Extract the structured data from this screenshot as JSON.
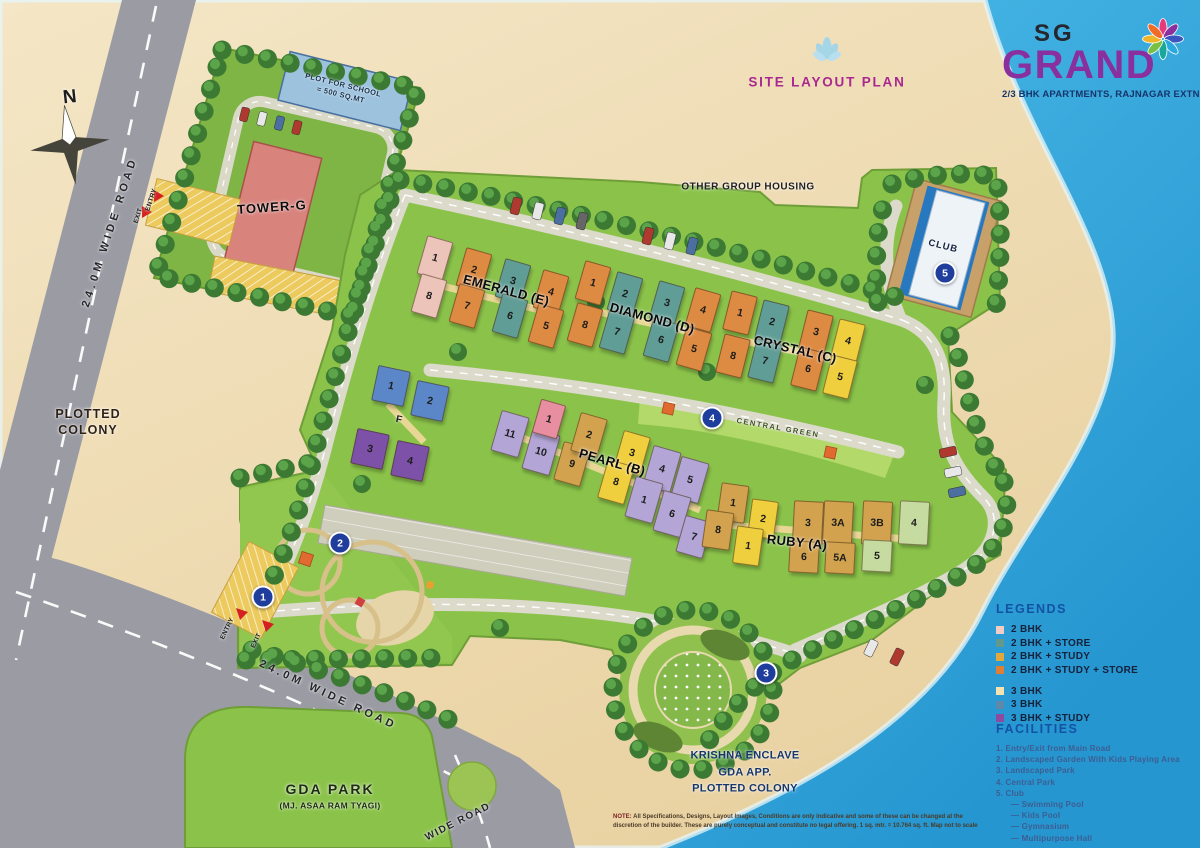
{
  "branding": {
    "logo_top": "SG",
    "logo_main": "GRAND",
    "tagline": "2/3 BHK APARTMENTS, RAJNAGAR EXTN."
  },
  "header": {
    "plan_title": "SITE LAYOUT PLAN"
  },
  "note": {
    "label": "NOTE:",
    "line1": "All Specifications, Designs, Layout Images, Conditions are only indicative and some of these can be changed at the discretion of the builder.",
    "line2": "These are purely conceptual and constitute no legal offering. 1 sq. mtr. = 10.764 sq. ft.   Map not to scale"
  },
  "legends": {
    "title": "LEGENDS",
    "items": [
      {
        "label": "2 BHK",
        "color": "#f2cdc6",
        "sw": "background:#f2cdc6"
      },
      {
        "label": "2 BHK + STORE",
        "color": "#63988d",
        "sw": "background:#63988d"
      },
      {
        "label": "2 BHK + STUDY",
        "color": "#e2a93a",
        "sw": "background:#e2a93a"
      },
      {
        "label": "2 BHK + STUDY + STORE",
        "color": "#df7f36",
        "sw": "background:#df7f36"
      },
      {
        "label": "3 BHK",
        "color": "#f6e2ae",
        "sw": "background:#f6e2ae"
      },
      {
        "label": "3 BHK",
        "color": "#5f89a8",
        "sw": "background:#5f89a8"
      },
      {
        "label": "3 BHK + STUDY",
        "color": "#8d4a9e",
        "sw": "background:#8d4a9e"
      }
    ]
  },
  "facilities": {
    "title": "FACILITIES",
    "items": [
      "1.  Entry/Exit from Main Road",
      "2.  Landscaped Garden With Kids Playing Area",
      "3.  Landscaped Park",
      "4.  Central Park",
      "5.  Club"
    ],
    "club_sub": [
      "— Swimming Pool",
      "— Kids Pool",
      "— Gymnasium",
      "— Multipurpose Hall"
    ]
  },
  "map": {
    "markers": [
      {
        "n": "1",
        "css": "left:263px;top:597px"
      },
      {
        "n": "2",
        "css": "left:340px;top:543px"
      },
      {
        "n": "3",
        "css": "left:766px;top:673px"
      },
      {
        "n": "4",
        "css": "left:712px;top:418px"
      },
      {
        "n": "5",
        "css": "left:945px;top:273px"
      }
    ],
    "labels": [
      {
        "text": "N",
        "css": "left:70px;top:98px;font-size:19px;font-weight:800;--r:-6deg"
      },
      {
        "text": "24.0M WIDE ROAD",
        "css": "left:110px;top:232px;font-size:11px;letter-spacing:4px;--r:-72deg;color:#26262a"
      },
      {
        "text": "PLOTTED\nCOLONY",
        "css": "left:88px;top:422px;font-size:12.5px;letter-spacing:1px;color:#2e2217"
      },
      {
        "text": "PLOT FOR SCHOOL\n= 500 SQ.MT",
        "css": "left:342px;top:90px;font-size:7.5px;--r:14deg;color:#17324f;letter-spacing:.4px"
      },
      {
        "text": "TOWER-G",
        "css": "left:272px;top:208px;font-size:13px;letter-spacing:1px;--r:-4deg;color:#0d0d0d"
      },
      {
        "text": "ENTRY",
        "css": "left:152px;top:200px;font-size:6.5px;--r:-72deg"
      },
      {
        "text": "EXIT",
        "css": "left:139px;top:216px;font-size:6.5px;--r:-72deg"
      },
      {
        "text": "OTHER GROUP HOUSING",
        "css": "left:748px;top:187px;font-size:10px;letter-spacing:.5px;color:#1f1f1f"
      },
      {
        "text": "EMERALD (E)",
        "css": "left:506px;top:291px;font-size:13px;--r:15deg;color:#0a0a0a"
      },
      {
        "text": "DIAMOND (D)",
        "css": "left:652px;top:319px;font-size:13px;--r:15deg;color:#0a0a0a"
      },
      {
        "text": "CRYSTAL (C)",
        "css": "left:795px;top:350px;font-size:13px;--r:13deg;color:#0a0a0a"
      },
      {
        "text": "PEARL (B)",
        "css": "left:612px;top:463px;font-size:13px;--r:16deg;color:#0a0a0a"
      },
      {
        "text": "RUBY (A)",
        "css": "left:797px;top:543px;font-size:13px;--r:6deg;color:#0a0a0a"
      },
      {
        "text": "F",
        "css": "left:399px;top:420px;font-size:10px;--r:12deg"
      },
      {
        "text": "CLUB",
        "css": "left:943px;top:247px;font-size:9.5px;letter-spacing:1px;--r:14deg;color:#14233f"
      },
      {
        "text": "CENTRAL GREEN",
        "css": "left:778px;top:428px;font-size:7.5px;letter-spacing:1.5px;--r:10deg;color:#3f5520"
      },
      {
        "text": "ENTRY",
        "css": "left:228px;top:629px;font-size:6.5px;--r:-64deg"
      },
      {
        "text": "EXIT",
        "css": "left:257px;top:641px;font-size:6.5px;--r:-64deg"
      },
      {
        "text": "24.0M WIDE ROAD",
        "css": "left:328px;top:695px;font-size:11px;letter-spacing:3.5px;--r:25deg;color:#26262a"
      },
      {
        "text": "WIDE ROAD",
        "css": "left:458px;top:822px;font-size:10px;letter-spacing:1.5px;--r:-27deg;color:#26262a"
      },
      {
        "text": "GDA PARK",
        "css": "left:330px;top:789px;font-size:14px;letter-spacing:2px;color:#1c2b12"
      },
      {
        "text": "(MJ. ASAA RAM TYAGI)",
        "css": "left:330px;top:806px;font-size:8.5px;color:#1c2b12"
      },
      {
        "text": "KRISHNA ENCLAVE\nGDA APP.\nPLOTTED COLONY",
        "css": "left:745px;top:772px;font-size:11px;font-weight:800;color:#16366b;line-height:1.5"
      }
    ],
    "units": [
      {
        "n": "1",
        "css": "left:435px;top:258px;width:25px;height:38px;background:#ecc4ba;--r:16deg"
      },
      {
        "n": "2",
        "css": "left:474px;top:270px;width:25px;height:38px;background:#dd8a42;--r:16deg"
      },
      {
        "n": "3",
        "css": "left:513px;top:281px;width:25px;height:38px;background:#5f9d96;--r:16deg"
      },
      {
        "n": "4",
        "css": "left:551px;top:292px;width:25px;height:38px;background:#dd8a42;--r:16deg"
      },
      {
        "n": "8",
        "css": "left:429px;top:296px;width:25px;height:38px;background:#ecc4ba;--r:16deg"
      },
      {
        "n": "7",
        "css": "left:467px;top:306px;width:25px;height:38px;background:#dd8a42;--r:16deg"
      },
      {
        "n": "6",
        "css": "left:510px;top:316px;width:25px;height:38px;background:#5f9d96;--r:16deg"
      },
      {
        "n": "5",
        "css": "left:546px;top:326px;width:25px;height:38px;background:#dd8a42;--r:16deg"
      },
      {
        "n": "1",
        "css": "left:593px;top:283px;width:25px;height:38px;background:#dd8a42;--r:16deg"
      },
      {
        "n": "2",
        "css": "left:625px;top:294px;width:25px;height:38px;background:#5f9d96;--r:16deg"
      },
      {
        "n": "3",
        "css": "left:667px;top:303px;width:25px;height:38px;background:#5f9d96;--r:16deg"
      },
      {
        "n": "4",
        "css": "left:703px;top:310px;width:25px;height:38px;background:#dd8a42;--r:16deg"
      },
      {
        "n": "8",
        "css": "left:585px;top:325px;width:25px;height:38px;background:#dd8a42;--r:16deg"
      },
      {
        "n": "7",
        "css": "left:617px;top:332px;width:25px;height:38px;background:#5f9d96;--r:16deg"
      },
      {
        "n": "6",
        "css": "left:661px;top:340px;width:25px;height:38px;background:#5f9d96;--r:16deg"
      },
      {
        "n": "5",
        "css": "left:694px;top:349px;width:25px;height:38px;background:#dd8a42;--r:16deg"
      },
      {
        "n": "1",
        "css": "left:740px;top:313px;width:25px;height:38px;background:#dd8a42;--r:14deg"
      },
      {
        "n": "2",
        "css": "left:772px;top:322px;width:25px;height:38px;background:#5f9d96;--r:14deg"
      },
      {
        "n": "3",
        "css": "left:816px;top:332px;width:25px;height:38px;background:#dd8a42;--r:14deg"
      },
      {
        "n": "4",
        "css": "left:848px;top:341px;width:25px;height:38px;background:#f0cf3f;--r:14deg"
      },
      {
        "n": "8",
        "css": "left:733px;top:356px;width:25px;height:38px;background:#dd8a42;--r:14deg"
      },
      {
        "n": "7",
        "css": "left:765px;top:361px;width:25px;height:38px;background:#5f9d96;--r:14deg"
      },
      {
        "n": "6",
        "css": "left:808px;top:369px;width:25px;height:38px;background:#dd8a42;--r:14deg"
      },
      {
        "n": "5",
        "css": "left:840px;top:377px;width:25px;height:38px;background:#f0cf3f;--r:14deg"
      },
      {
        "n": "1",
        "css": "left:391px;top:386px;width:31px;height:34px;background:#5b87c8;--r:12deg"
      },
      {
        "n": "2",
        "css": "left:430px;top:401px;width:31px;height:34px;background:#5b87c8;--r:12deg"
      },
      {
        "n": "3",
        "css": "left:370px;top:449px;width:31px;height:34px;background:#7d51a8;--r:12deg"
      },
      {
        "n": "4",
        "css": "left:410px;top:461px;width:31px;height:34px;background:#7d51a8;--r:12deg"
      },
      {
        "n": "11",
        "css": "left:510px;top:434px;width:27px;height:40px;background:#b3a6d6;--r:16deg"
      },
      {
        "n": "10",
        "css": "left:541px;top:452px;width:27px;height:40px;background:#b3a6d6;--r:16deg"
      },
      {
        "n": "9",
        "css": "left:572px;top:464px;width:26px;height:38px;background:#d2a24e;--r:16deg"
      },
      {
        "n": "1",
        "css": "left:549px;top:419px;width:24px;height:33px;background:#e78fa0;--r:16deg"
      },
      {
        "n": "2",
        "css": "left:589px;top:435px;width:26px;height:38px;background:#d2a24e;--r:16deg"
      },
      {
        "n": "3",
        "css": "left:632px;top:453px;width:26px;height:38px;background:#f0cf3f;--r:16deg"
      },
      {
        "n": "8",
        "css": "left:616px;top:482px;width:26px;height:38px;background:#f0cf3f;--r:16deg"
      },
      {
        "n": "4",
        "css": "left:662px;top:469px;width:27px;height:40px;background:#b3a6d6;--r:16deg"
      },
      {
        "n": "5",
        "css": "left:690px;top:480px;width:27px;height:40px;background:#b3a6d6;--r:16deg"
      },
      {
        "n": "1",
        "css": "left:644px;top:500px;width:27px;height:40px;background:#b3a6d6;--r:16deg"
      },
      {
        "n": "6",
        "css": "left:672px;top:514px;width:27px;height:40px;background:#b3a6d6;--r:16deg"
      },
      {
        "n": "7",
        "css": "left:694px;top:537px;width:26px;height:36px;background:#b3a6d6;--r:16deg"
      },
      {
        "n": "1",
        "css": "left:733px;top:503px;width:26px;height:36px;background:#d2a24e;--r:8deg"
      },
      {
        "n": "2",
        "css": "left:763px;top:519px;width:25px;height:36px;background:#f0cf3f;--r:8deg"
      },
      {
        "n": "8",
        "css": "left:718px;top:530px;width:26px;height:36px;background:#d2a24e;--r:8deg"
      },
      {
        "n": "1",
        "css": "left:748px;top:546px;width:25px;height:36px;background:#f0cf3f;--r:8deg"
      },
      {
        "n": "3",
        "css": "left:808px;top:523px;width:28px;height:42px;background:#d2a24e;--r:3deg"
      },
      {
        "n": "3A",
        "css": "left:838px;top:523px;width:28px;height:42px;background:#d2a24e;--r:3deg"
      },
      {
        "n": "3B",
        "css": "left:877px;top:523px;width:28px;height:42px;background:#d2a24e;--r:3deg"
      },
      {
        "n": "4",
        "css": "left:914px;top:523px;width:28px;height:42px;background:#c6dba0;--r:3deg"
      },
      {
        "n": "6",
        "css": "left:804px;top:557px;width:28px;height:30px;background:#d2a24e;--r:3deg"
      },
      {
        "n": "5A",
        "css": "left:840px;top:558px;width:28px;height:30px;background:#d2a24e;--r:3deg"
      },
      {
        "n": "5",
        "css": "left:877px;top:556px;width:28px;height:30px;background:#c6dba0;--r:3deg"
      }
    ]
  }
}
